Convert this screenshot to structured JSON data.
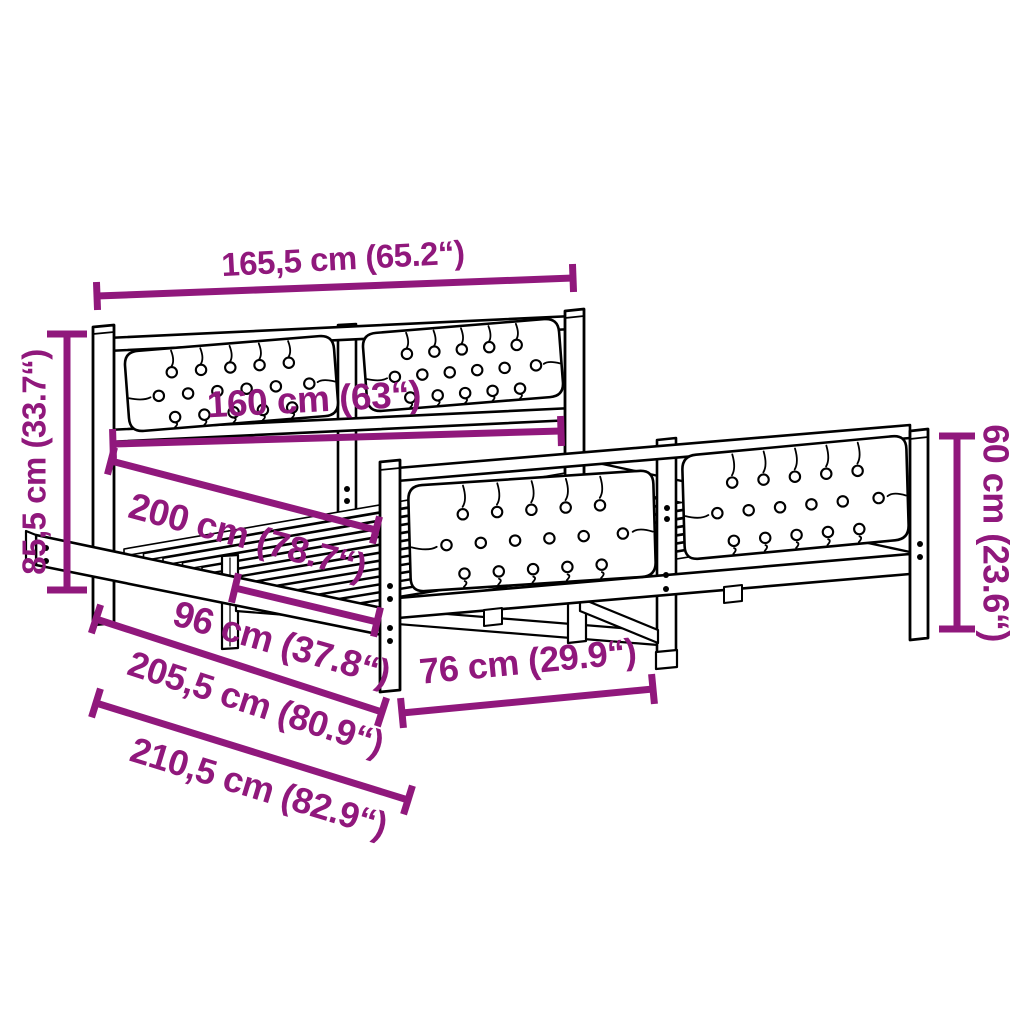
{
  "diagram": {
    "type": "product-dimension-diagram",
    "product": "bed frame with tufted headboard and footboard"
  },
  "colors": {
    "accent": "#90187c",
    "line": "#000000",
    "background": "#ffffff"
  },
  "dimensions": {
    "total_width_top": {
      "label": "165,5 cm (65.2“)"
    },
    "headboard_height": {
      "label": "85,5 cm (33.7“)"
    },
    "inner_width": {
      "label": "160 cm (63“)"
    },
    "mattress_length": {
      "label": "200 cm (78.7“)"
    },
    "inner_span": {
      "label": "96 cm (37.8“)"
    },
    "frame_length": {
      "label": "205,5 cm (80.9“)"
    },
    "total_length": {
      "label": "210,5 cm (82.9“)"
    },
    "footboard_span": {
      "label": "76 cm (29.9“)"
    },
    "footboard_height": {
      "label": "60 cm (23.6“)"
    }
  }
}
